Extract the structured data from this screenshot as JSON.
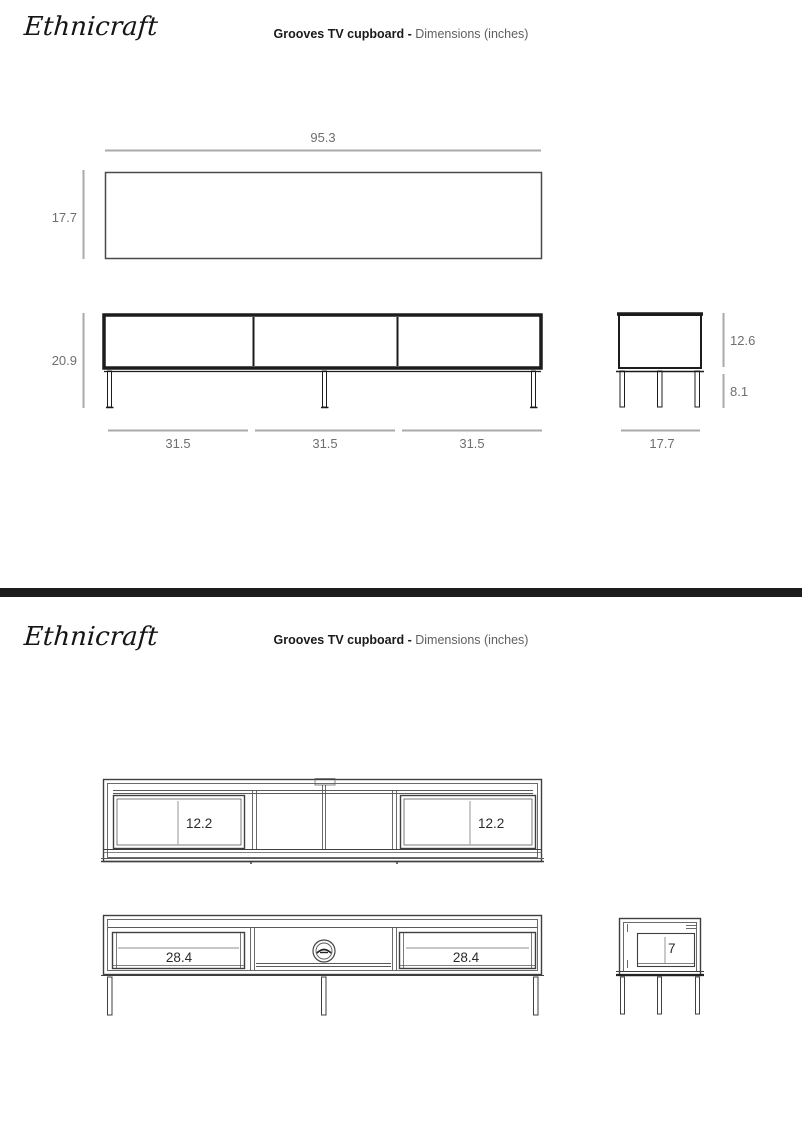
{
  "brand": "Ethnicraft",
  "title": {
    "product": "Grooves TV cupboard -",
    "subtitle": "Dimensions (inches)"
  },
  "page1": {
    "top_view": {
      "width": "95.3",
      "depth": "17.7"
    },
    "front_view": {
      "height": "20.9",
      "sections": [
        "31.5",
        "31.5",
        "31.5"
      ]
    },
    "side_view": {
      "body_height": "12.6",
      "leg_height": "8.1",
      "depth": "17.7"
    }
  },
  "page2": {
    "top_view": {
      "drawer_depths": [
        "12.2",
        "12.2"
      ]
    },
    "front_view": {
      "drawer_widths": [
        "28.4",
        "28.4"
      ]
    },
    "side_view": {
      "drawer_height": "7"
    }
  },
  "colors": {
    "line_dark": "#1c1c1c",
    "line_cad": "#3f3f3f",
    "dim_line": "#a9a9a9",
    "dim_text_page1": "#6e6e6e",
    "dim_text_page2": "#2b2b2b",
    "divider": "#1d1d1d"
  }
}
